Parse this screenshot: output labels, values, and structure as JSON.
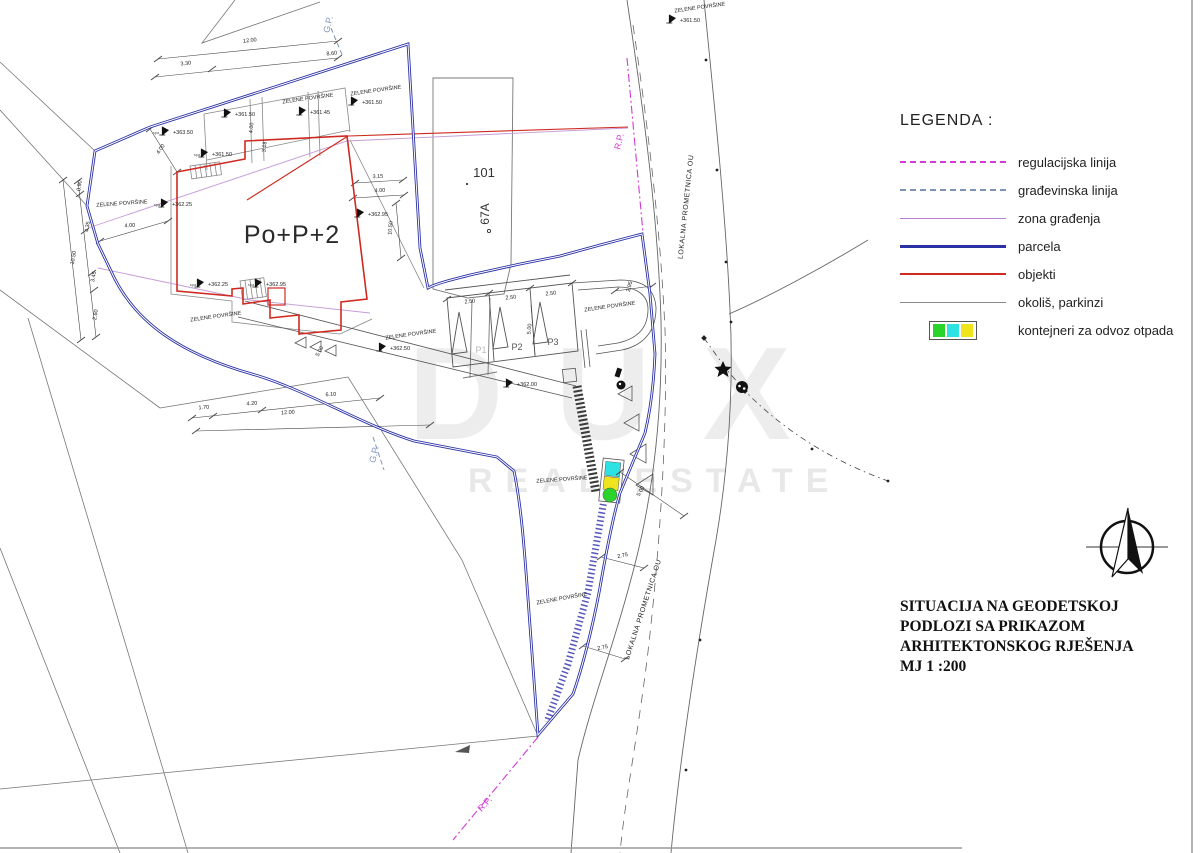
{
  "legend": {
    "title": "LEGENDA :",
    "items": [
      {
        "label": "regulacijska linija",
        "swatch": "dashed",
        "color": "#d23bd2",
        "icon": "magenta-dashed-line"
      },
      {
        "label": "građevinska linija",
        "swatch": "dashed",
        "color": "#7f93b8",
        "icon": "gray-blue-dashed-line"
      },
      {
        "label": "zona građenja",
        "swatch": "solid-thin",
        "color": "#b77fd0",
        "icon": "violet-line"
      },
      {
        "label": "parcela",
        "swatch": "solid-thick",
        "color": "#2b31a5",
        "icon": "blue-line"
      },
      {
        "label": "objekti",
        "swatch": "solid-medium",
        "color": "#cf2a21",
        "icon": "red-line"
      },
      {
        "label": "okoliš, parkinzi",
        "swatch": "solid-thin",
        "color": "#8a8a8a",
        "icon": "gray-line"
      },
      {
        "label": "kontejneri za odvoz otpada",
        "swatch": "containers",
        "colors": [
          "#2bd42b",
          "#2de2e2",
          "#f0e41c"
        ],
        "icon": "waste-containers"
      }
    ]
  },
  "title_block": {
    "lines": [
      "SITUACIJA NA GEODETSKOJ",
      "PODLOZI SA PRIKAZOM",
      "ARHITEKTONSKOG RJEŠENJA",
      "MJ 1 :200"
    ]
  },
  "watermark": {
    "line1": "DUX",
    "line2": "REAL ESTATE"
  },
  "plan": {
    "labels": [
      {
        "t": "Po+P+2",
        "x": 292,
        "y": 243,
        "s": 25,
        "c": "#2a2a2a",
        "ls": 1,
        "n": "building-label"
      },
      {
        "t": "101",
        "x": 484,
        "y": 177,
        "s": 13,
        "c": "#333",
        "n": "plot-number"
      },
      {
        "t": "67A",
        "x": 489,
        "y": 214,
        "s": 12,
        "r": -90,
        "c": "#333",
        "n": "plot-number"
      },
      {
        "t": "LOKALNA PROMETNICA OU",
        "x": 688,
        "y": 207,
        "s": 7,
        "r": -84,
        "ls": 0.6,
        "n": "road-label"
      },
      {
        "t": "LOKALNA PROMETNICA OU",
        "x": 645,
        "y": 610,
        "s": 7,
        "r": -72,
        "ls": 0.6,
        "n": "road-label"
      },
      {
        "t": "R.P.",
        "x": 622,
        "y": 142,
        "s": 9,
        "r": -77,
        "c": "#d23bd2",
        "n": "regulation-line-label"
      },
      {
        "t": "R.P.",
        "x": 487,
        "y": 806,
        "s": 9,
        "r": -48,
        "c": "#d23bd2",
        "n": "regulation-line-label"
      },
      {
        "t": "G.P.",
        "x": 331,
        "y": 25,
        "s": 9,
        "r": -77,
        "c": "#7f93b8",
        "n": "building-line-label"
      },
      {
        "t": "G.P.",
        "x": 377,
        "y": 455,
        "s": 9,
        "r": -77,
        "c": "#7f93b8",
        "n": "building-line-label"
      },
      {
        "t": "ZELENE POVRŠINE",
        "x": 308,
        "y": 100,
        "s": 5.5,
        "r": -8,
        "n": "green-area-label"
      },
      {
        "t": "ZELENE POVRŠINE",
        "x": 376,
        "y": 92,
        "s": 5.5,
        "r": -8,
        "n": "green-area-label"
      },
      {
        "t": "ZELENE POVRŠINE",
        "x": 700,
        "y": 9,
        "s": 5.5,
        "r": -8,
        "n": "green-area-label"
      },
      {
        "t": "ZELENE POVRŠINE",
        "x": 122,
        "y": 205,
        "s": 5.5,
        "r": -4,
        "n": "green-area-label"
      },
      {
        "t": "ZELENE POVRŠINE",
        "x": 216,
        "y": 318,
        "s": 5.5,
        "r": -8,
        "n": "green-area-label"
      },
      {
        "t": "ZELENE POVRŠINE",
        "x": 411,
        "y": 336,
        "s": 5.5,
        "r": -8,
        "n": "green-area-label"
      },
      {
        "t": "ZELENE POVRŠINE",
        "x": 610,
        "y": 308,
        "s": 5.5,
        "r": -8,
        "n": "green-area-label"
      },
      {
        "t": "ZELENE POVRŠINE",
        "x": 562,
        "y": 481,
        "s": 5.5,
        "r": -4,
        "n": "green-area-label"
      },
      {
        "t": "ZELENE POVRŠINE",
        "x": 562,
        "y": 600,
        "s": 5.5,
        "r": -10,
        "n": "green-area-label"
      },
      {
        "t": "P1",
        "x": 481,
        "y": 353,
        "s": 9,
        "c": "#bbbbbb",
        "n": "parking-stall-label"
      },
      {
        "t": "P2",
        "x": 517,
        "y": 350,
        "s": 9,
        "c": "#555555",
        "n": "parking-stall-label"
      },
      {
        "t": "P3",
        "x": 553,
        "y": 345,
        "s": 9,
        "c": "#555555",
        "n": "parking-stall-label"
      },
      {
        "t": "+363.50",
        "x": 183,
        "y": 134,
        "s": 5.5,
        "m": true,
        "n": "elevation-label"
      },
      {
        "t": "+361.50",
        "x": 245,
        "y": 116,
        "s": 5.5,
        "m": true,
        "n": "elevation-label"
      },
      {
        "t": "+361.45",
        "x": 320,
        "y": 114,
        "s": 5.5,
        "m": true,
        "n": "elevation-label"
      },
      {
        "t": "+361.50",
        "x": 372,
        "y": 104,
        "s": 5.5,
        "m": true,
        "n": "elevation-label"
      },
      {
        "t": "+361.50",
        "x": 690,
        "y": 22,
        "s": 5.5,
        "m": true,
        "n": "elevation-label"
      },
      {
        "t": "+361.50",
        "x": 222,
        "y": 156,
        "s": 5.5,
        "m": true,
        "n": "elevation-label"
      },
      {
        "t": "+362.25",
        "x": 182,
        "y": 206,
        "s": 5.5,
        "m": true,
        "n": "elevation-label"
      },
      {
        "t": "+362.95",
        "x": 378,
        "y": 216,
        "s": 5.5,
        "m": true,
        "n": "elevation-label"
      },
      {
        "t": "+362.25",
        "x": 218,
        "y": 286,
        "s": 5.5,
        "m": true,
        "n": "elevation-label"
      },
      {
        "t": "+362.95",
        "x": 276,
        "y": 286,
        "s": 5.5,
        "m": true,
        "n": "elevation-label"
      },
      {
        "t": "+362.50",
        "x": 400,
        "y": 350,
        "s": 5.5,
        "m": true,
        "n": "elevation-label"
      },
      {
        "t": "+362.00",
        "x": 527,
        "y": 386,
        "s": 5.5,
        "m": true,
        "n": "elevation-label"
      },
      {
        "t": "spa",
        "x": 156,
        "y": 134,
        "s": 4,
        "c": "#555",
        "n": "bench-note"
      },
      {
        "t": "spa",
        "x": 197,
        "y": 156,
        "s": 4,
        "c": "#555",
        "n": "bench-note"
      },
      {
        "t": "spa",
        "x": 157,
        "y": 206,
        "s": 4,
        "c": "#555",
        "n": "bench-note"
      },
      {
        "t": "spa",
        "x": 193,
        "y": 286,
        "s": 4,
        "c": "#555",
        "n": "bench-note"
      },
      {
        "t": "spa",
        "x": 251,
        "y": 286,
        "s": 4,
        "c": "#555",
        "n": "bench-note"
      },
      {
        "t": "12.00",
        "x": 250,
        "y": 42,
        "s": 5.5,
        "r": -6,
        "n": "dimension-label"
      },
      {
        "t": "8.60",
        "x": 332,
        "y": 55,
        "s": 5.5,
        "r": -6,
        "n": "dimension-label"
      },
      {
        "t": "3.30",
        "x": 186,
        "y": 65,
        "s": 5.5,
        "r": -6,
        "n": "dimension-label"
      },
      {
        "t": "3.15",
        "x": 378,
        "y": 178,
        "s": 5.5,
        "r": -3,
        "n": "dimension-label"
      },
      {
        "t": "4.00",
        "x": 380,
        "y": 192,
        "s": 5.5,
        "r": -3,
        "n": "dimension-label"
      },
      {
        "t": "10.50",
        "x": 392,
        "y": 228,
        "s": 5.5,
        "r": -85,
        "n": "dimension-label"
      },
      {
        "t": "3.18",
        "x": 266,
        "y": 147,
        "s": 5.5,
        "r": -85,
        "n": "dimension-label"
      },
      {
        "t": "4.00",
        "x": 253,
        "y": 128,
        "s": 5.5,
        "r": -85,
        "n": "dimension-label"
      },
      {
        "t": "4.00",
        "x": 130,
        "y": 227,
        "s": 5.5,
        "r": -4,
        "n": "dimension-label"
      },
      {
        "t": "4.00",
        "x": 162,
        "y": 150,
        "s": 5.5,
        "r": -55,
        "n": "dimension-label"
      },
      {
        "t": "0.90",
        "x": 81,
        "y": 186,
        "s": 5.5,
        "r": -80,
        "n": "dimension-label"
      },
      {
        "t": "4.35",
        "x": 89,
        "y": 227,
        "s": 5.5,
        "r": -80,
        "n": "dimension-label"
      },
      {
        "t": "10.50",
        "x": 75,
        "y": 258,
        "s": 5.5,
        "r": -80,
        "n": "dimension-label"
      },
      {
        "t": "3.45",
        "x": 95,
        "y": 277,
        "s": 5.5,
        "r": -80,
        "n": "dimension-label"
      },
      {
        "t": "2.60",
        "x": 97,
        "y": 315,
        "s": 5.5,
        "r": -80,
        "n": "dimension-label"
      },
      {
        "t": "1.70",
        "x": 204,
        "y": 409,
        "s": 5.5,
        "r": -4,
        "n": "dimension-label"
      },
      {
        "t": "4.20",
        "x": 252,
        "y": 405,
        "s": 5.5,
        "r": -4,
        "n": "dimension-label"
      },
      {
        "t": "12.00",
        "x": 288,
        "y": 414,
        "s": 5.5,
        "r": -4,
        "n": "dimension-label"
      },
      {
        "t": "6.10",
        "x": 331,
        "y": 396,
        "s": 5.5,
        "r": -4,
        "n": "dimension-label"
      },
      {
        "t": "2.50",
        "x": 470,
        "y": 303,
        "s": 5.5,
        "r": -5,
        "n": "dimension-label"
      },
      {
        "t": "2.50",
        "x": 511,
        "y": 299,
        "s": 5.5,
        "r": -5,
        "n": "dimension-label"
      },
      {
        "t": "2.50",
        "x": 551,
        "y": 295,
        "s": 5.5,
        "r": -5,
        "n": "dimension-label"
      },
      {
        "t": "5.00",
        "x": 531,
        "y": 329,
        "s": 5.5,
        "r": -85,
        "n": "dimension-label"
      },
      {
        "t": "5.00",
        "x": 321,
        "y": 352,
        "s": 5.5,
        "r": -62,
        "n": "dimension-label"
      },
      {
        "t": "5.00",
        "x": 642,
        "y": 492,
        "s": 5.5,
        "r": -60,
        "n": "dimension-label"
      },
      {
        "t": "2.95",
        "x": 631,
        "y": 287,
        "s": 5.5,
        "r": -75,
        "n": "dimension-label"
      },
      {
        "t": "2.75",
        "x": 623,
        "y": 557,
        "s": 5.5,
        "r": -12,
        "n": "dimension-label"
      },
      {
        "t": "2.75",
        "x": 603,
        "y": 649,
        "s": 5.5,
        "r": -12,
        "n": "dimension-label"
      }
    ]
  }
}
